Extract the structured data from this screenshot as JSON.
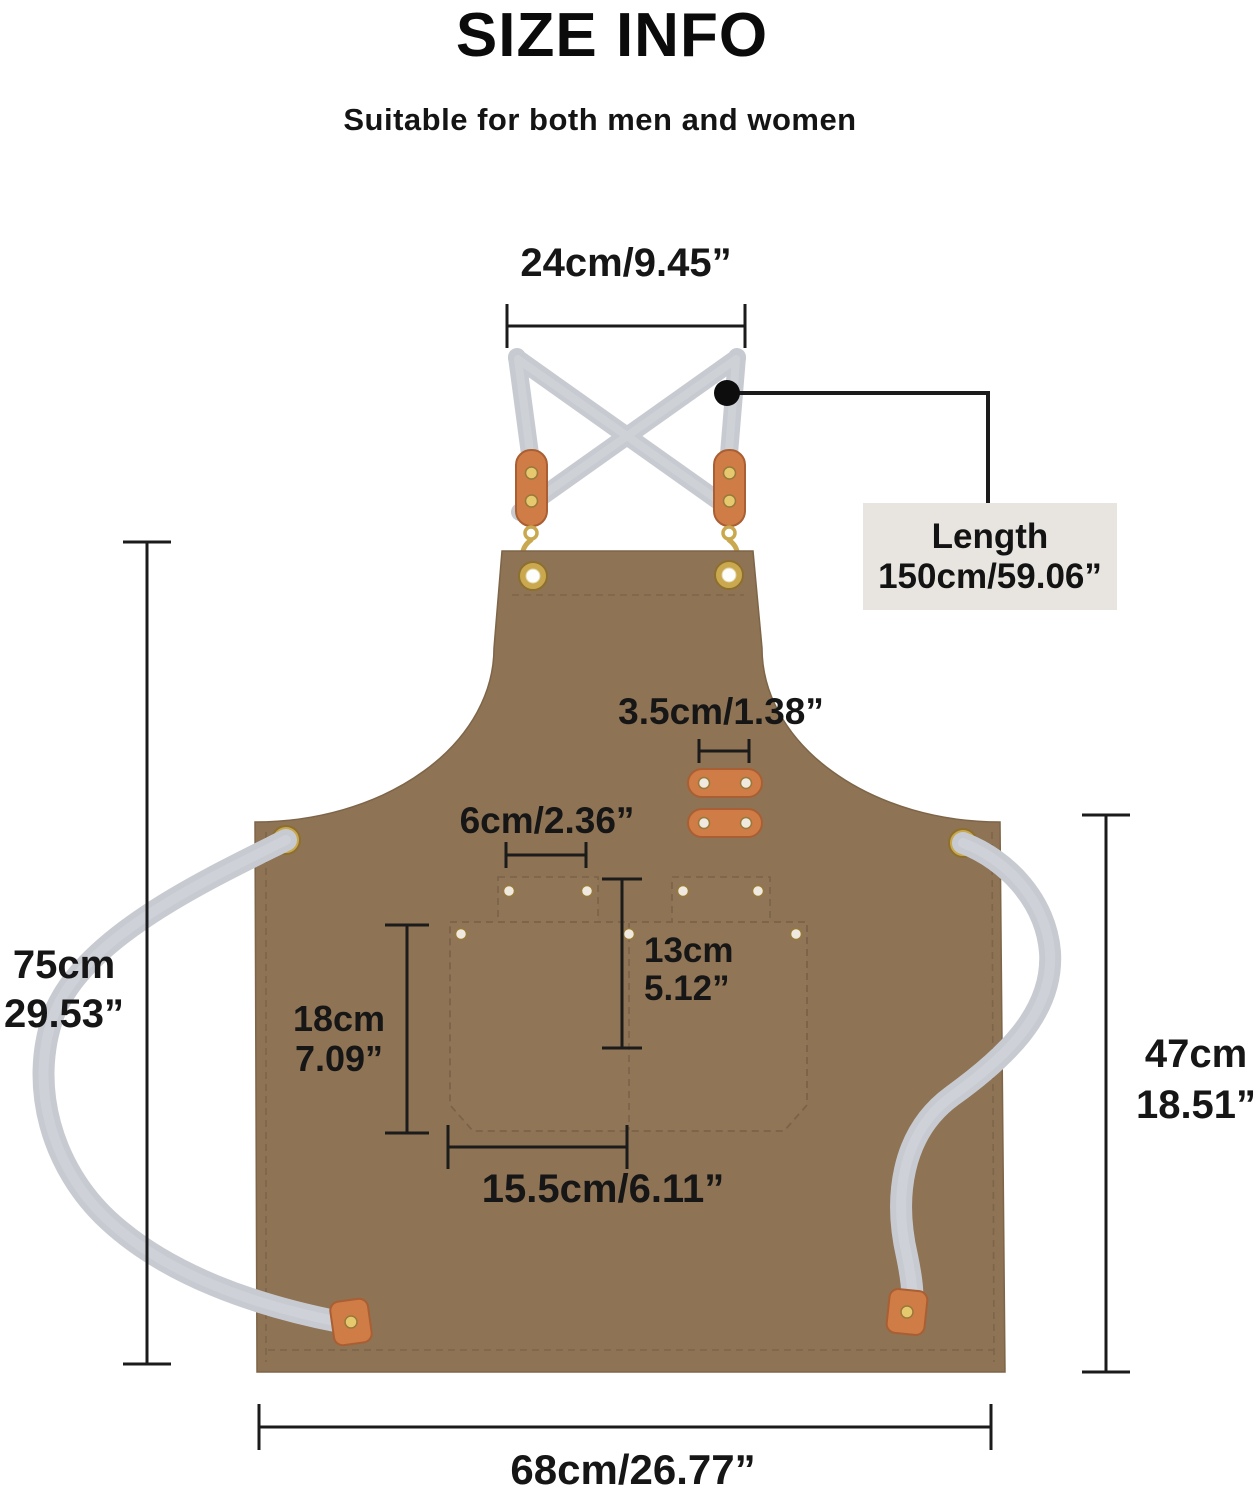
{
  "header": {
    "title": "SIZE INFO",
    "subtitle": "Suitable for both men and women"
  },
  "dimensions": {
    "neck_strap_width": "24cm/9.45”",
    "strap_length_label": "Length",
    "strap_length_value": "150cm/59.06”",
    "leather_loop_width": "3.5cm/1.38”",
    "small_pocket_width": "6cm/2.36”",
    "pocket_depth_cm": "13cm",
    "pocket_depth_in": "5.12”",
    "pocket_height_cm": "18cm",
    "pocket_height_in": "7.09”",
    "pocket_width": "15.5cm/6.11”",
    "apron_length_cm": "75cm",
    "apron_length_in": "29.53”",
    "skirt_length_cm": "47cm",
    "skirt_length_in": "18.51”",
    "bottom_width": "68cm/26.77”"
  },
  "colors": {
    "apron_canvas": "#8e7355",
    "strap_gray": "#c7cbd1",
    "leather_tan": "#d07c46",
    "hardware_gold": "#c9a84f",
    "callout_box_bg": "#e8e5e1",
    "dimension_line": "#1b1b1b"
  }
}
